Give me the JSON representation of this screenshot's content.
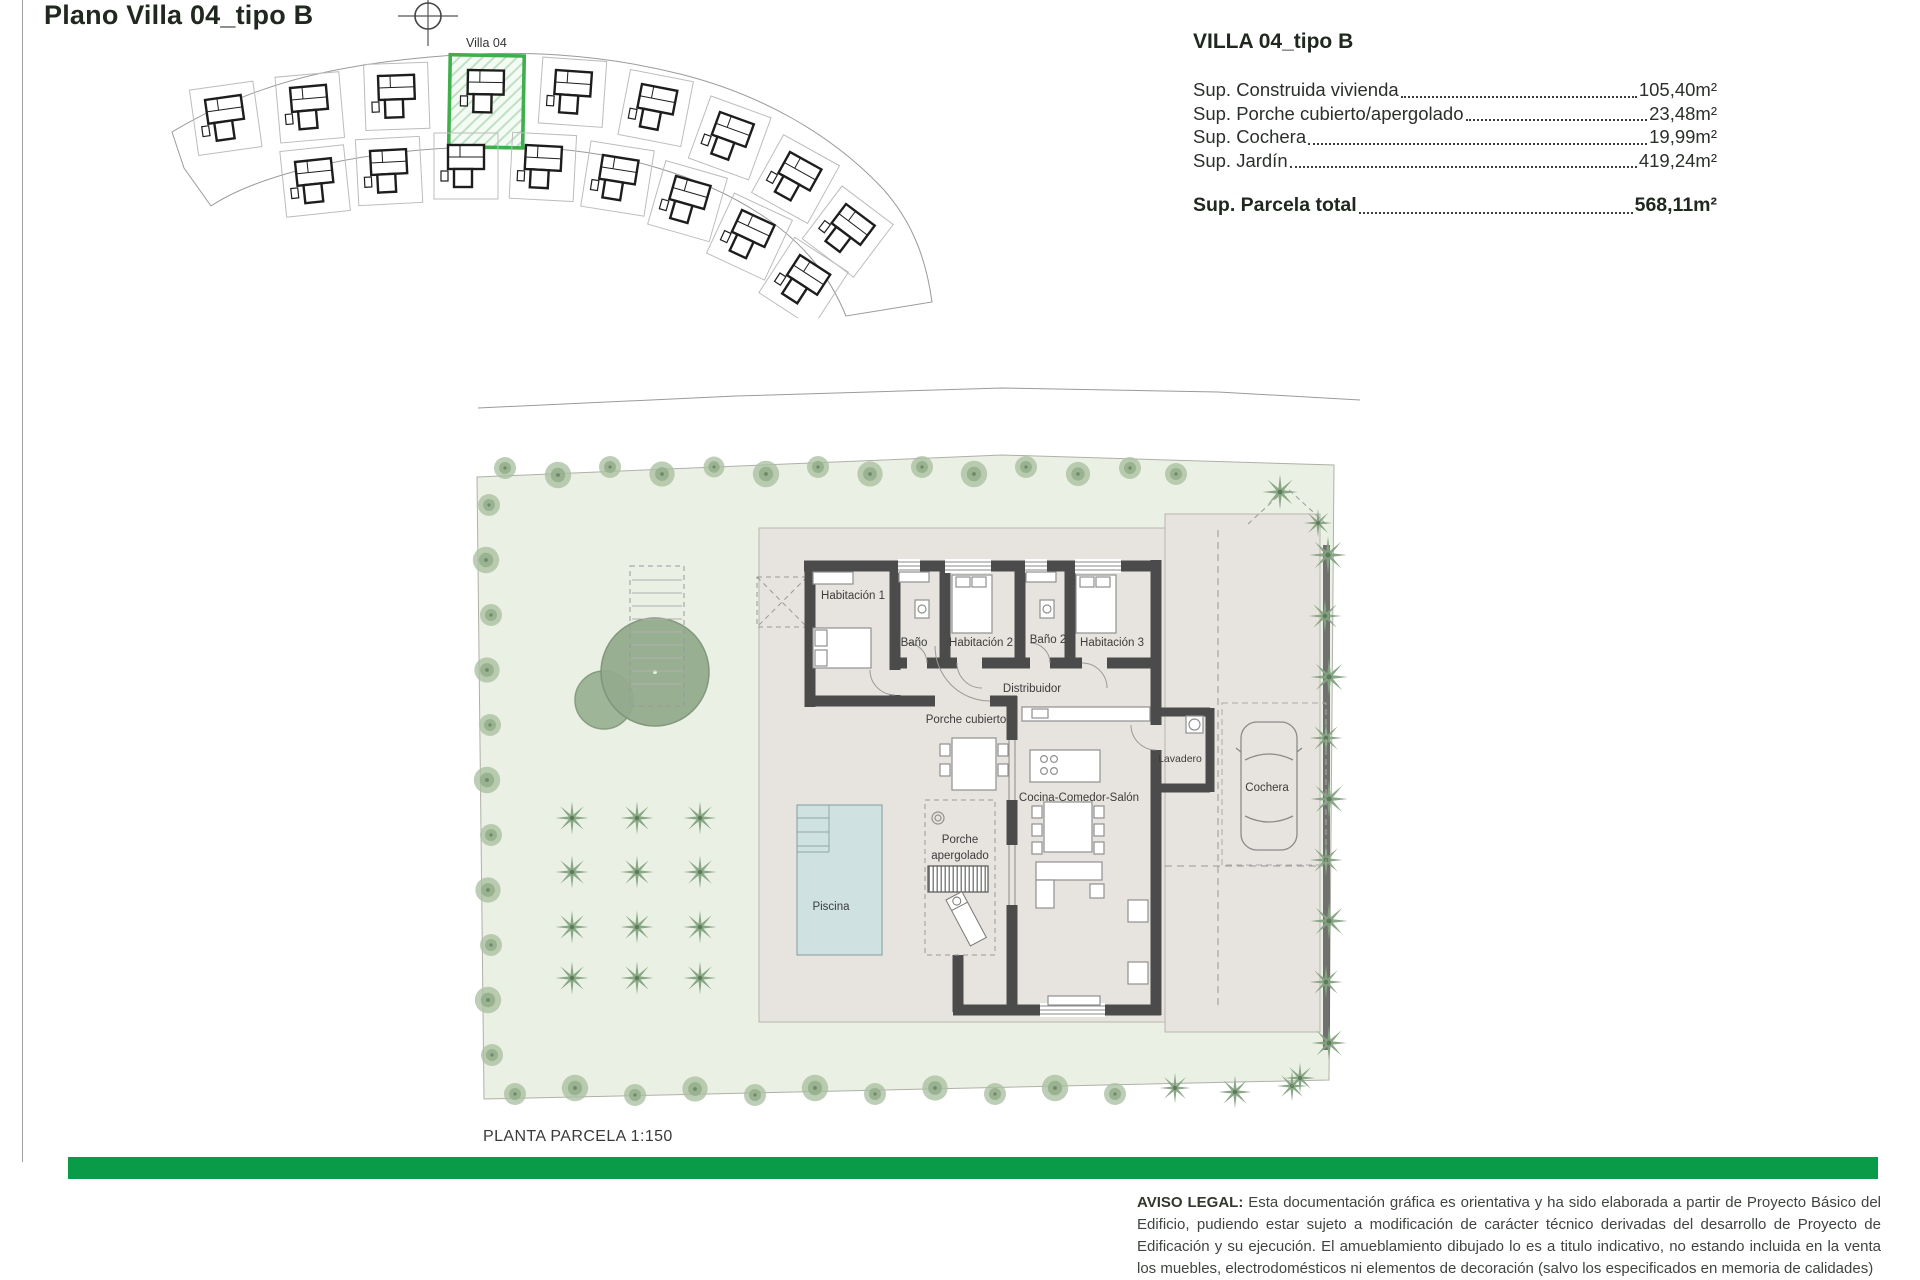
{
  "page": {
    "title": "Plano Villa 04_tipo B"
  },
  "site_plan": {
    "villa_label": "Villa 04",
    "highlight_color": "#3faf4c"
  },
  "info_panel": {
    "title": "VILLA 04_tipo B",
    "rows": [
      {
        "label": "Sup. Construida vivienda",
        "value": "105,40m²"
      },
      {
        "label": "Sup. Porche cubierto/apergolado",
        "value": "23,48m²"
      },
      {
        "label": "Sup. Cochera",
        "value": "19,99m²"
      },
      {
        "label": "Sup. Jardín",
        "value": "419,24m²"
      }
    ],
    "total": {
      "label": "Sup. Parcela total",
      "value": "568,11m²"
    }
  },
  "plan": {
    "caption": "PLANTA PARCELA 1:150",
    "rooms": [
      "Habitación 1",
      "Baño",
      "Habitación 2",
      "Baño 2",
      "Habitación 3",
      "Distribuidor",
      "Porche cubierto",
      "Cocina-Comedor-Salón",
      "Lavadero",
      "Cochera",
      "Piscina"
    ],
    "porche_apergolado": {
      "line1": "Porche",
      "line2": "apergolado"
    },
    "pool_color": "#cfe1e1",
    "garden_color": "#eaf0e4",
    "hardscape_color": "#e7e4df"
  },
  "footer": {
    "bar_color": "#0a9b49",
    "legal_title": "AVISO LEGAL:",
    "legal_body": " Esta documentación gráfica es orientativa y ha sido elaborada a partir de Proyecto Básico del Edificio, pudiendo estar sujeto a modificación de carácter técnico derivadas del desarrollo de Proyecto de Edificación y su ejecución. El amueblamiento dibujado lo es a titulo indicativo, no estando incluida en la venta los muebles, electrodomésticos ni elementos de decoración (salvo los especificados en memoria de calidades)"
  }
}
